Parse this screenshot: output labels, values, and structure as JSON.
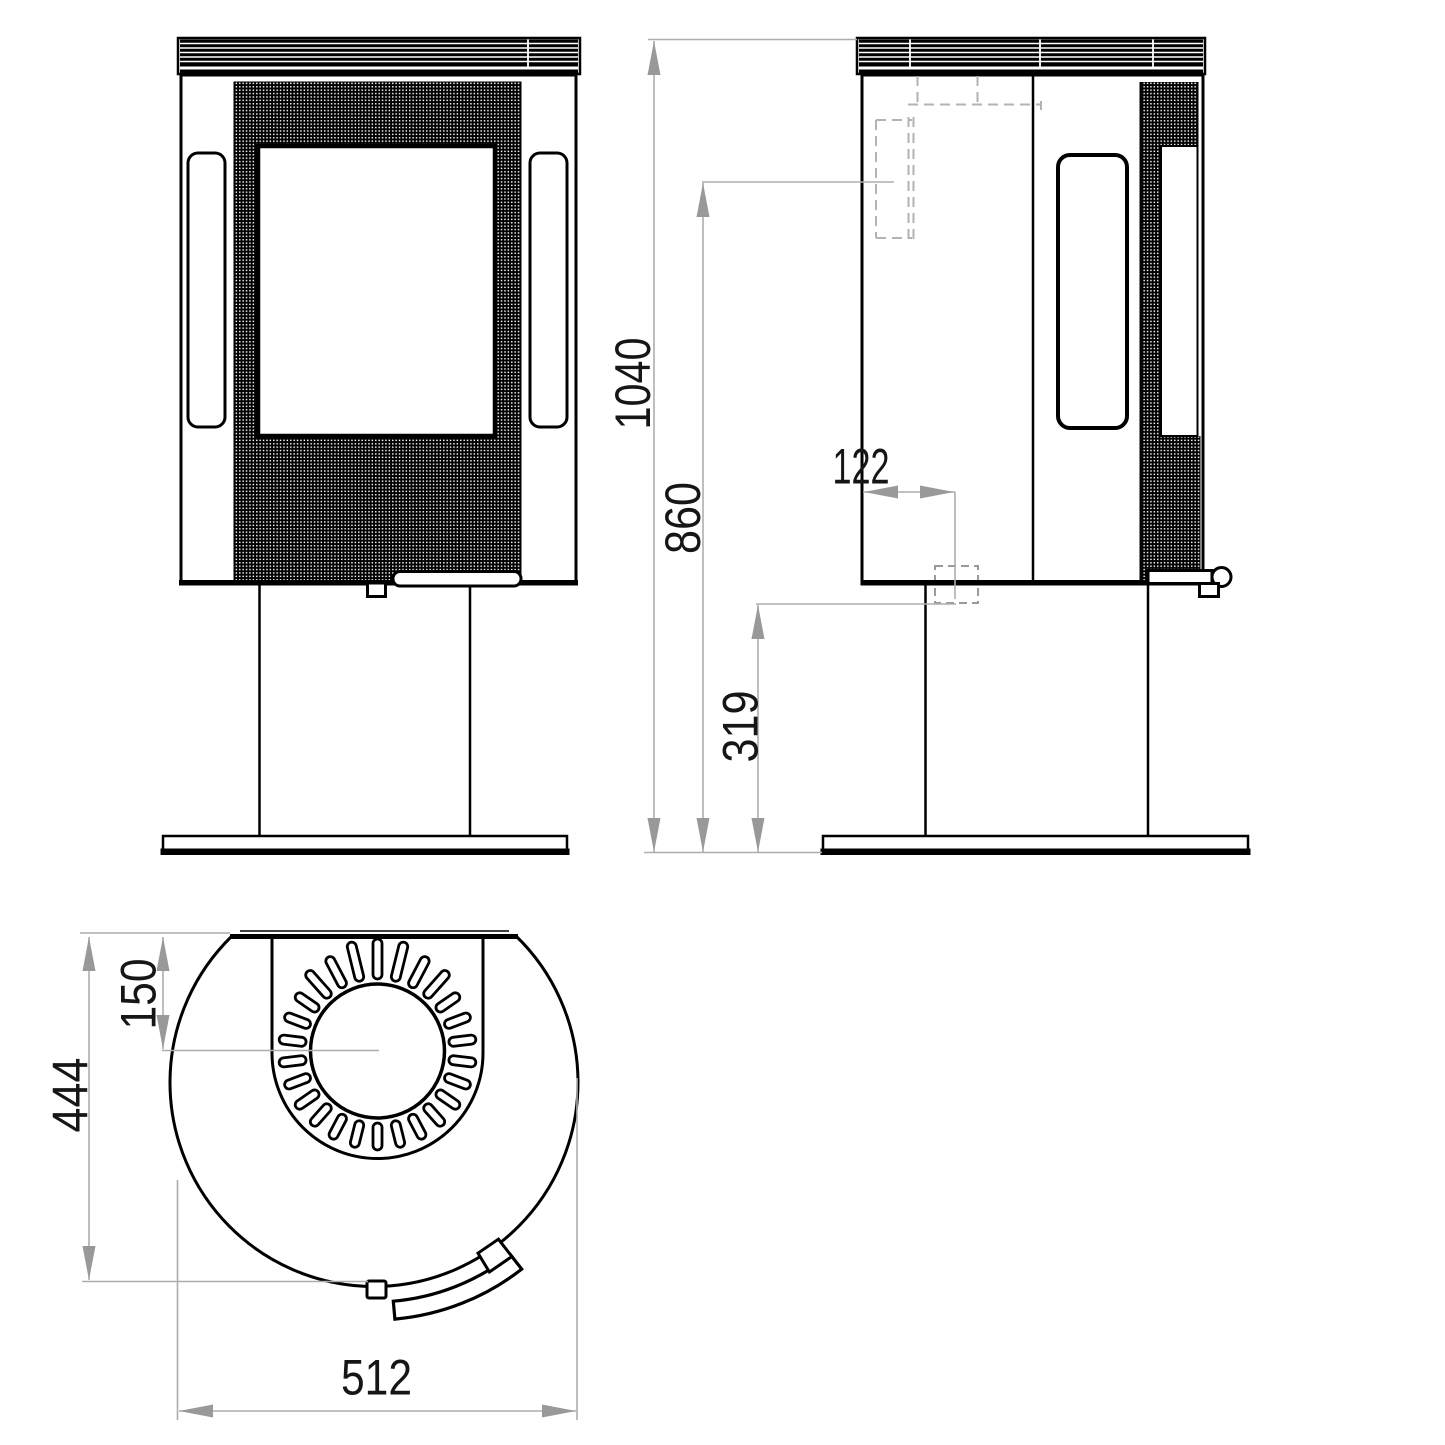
{
  "meta": {
    "subject": "Wood stove on pedestal - dimensioned three-view technical drawing",
    "units": "mm"
  },
  "dimensions": {
    "height_total": "1040",
    "height_flue_rear_center": "860",
    "flue_offset_from_back": "122",
    "height_rear_connection": "319",
    "flue_center_from_back": "150",
    "depth_total": "444",
    "width_total": "512"
  },
  "colors": {
    "line": "#000000",
    "dimension_line": "#adadad",
    "dimension_arrow": "#999999",
    "dashed_hidden_line": "#b3b3b3",
    "label": "#161616",
    "background": "#ffffff"
  }
}
